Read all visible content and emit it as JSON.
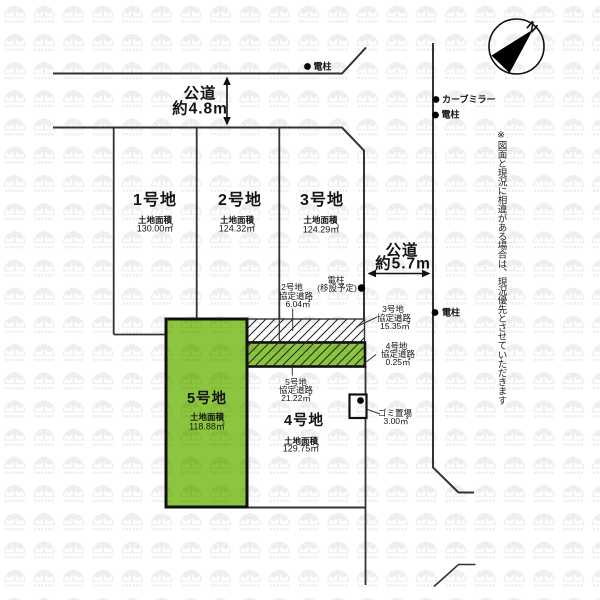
{
  "colors": {
    "parcel_green": "#8cc63e",
    "line": "#333333",
    "background": "#ffffff",
    "watermark_gray": "#e9e9e9"
  },
  "compass": {
    "north_label": "N"
  },
  "roads": {
    "top": {
      "name": "公道",
      "width": "約4.8m"
    },
    "east": {
      "name": "公道",
      "width": "約5.7m"
    }
  },
  "parcels": [
    {
      "label": "1号地",
      "area_caption": "土地面積",
      "area": "130.00㎡"
    },
    {
      "label": "2号地",
      "area_caption": "土地面積",
      "area": "124.32㎡"
    },
    {
      "label": "3号地",
      "area_caption": "土地面積",
      "area": "124.29㎡"
    },
    {
      "label": "4号地",
      "area_caption": "土地面積",
      "area": "129.75㎡"
    },
    {
      "label": "5号地",
      "area_caption": "土地面積",
      "area": "118.88㎡"
    }
  ],
  "agreement_roads": [
    {
      "parcel": "2号地",
      "type": "協定道路",
      "area": "6.04㎡"
    },
    {
      "parcel": "3号地",
      "type": "協定道路",
      "area": "15.35㎡"
    },
    {
      "parcel": "4号地",
      "type": "協定道路",
      "area": "0.25㎡"
    },
    {
      "parcel": "5号地",
      "type": "協定道路",
      "area": "21.22㎡"
    }
  ],
  "landmarks": {
    "pole_top": "電柱",
    "curve_mirror": "カーブミラー",
    "pole_east_upper": "電柱",
    "pole_east_mid": "電柱",
    "pole_relocation_line1": "電柱",
    "pole_relocation_line2": "(移設予定)",
    "trash_area_label": "ゴミ置場",
    "trash_area_value": "3.00㎡"
  },
  "disclaimer": "※図面と現況に相違がある場合は、現況優先とさせていただきます"
}
